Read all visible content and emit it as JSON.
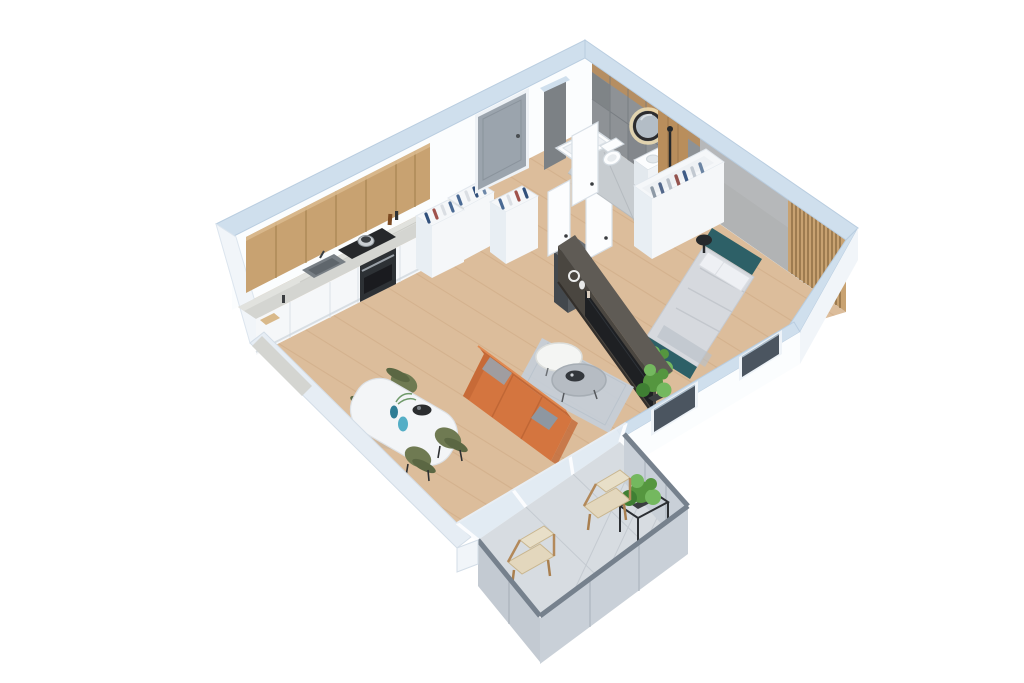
{
  "meta": {
    "description": "3D isometric dollhouse rendering of a one-bedroom apartment floor plan viewed from above on a white background. No text is visible in the image.",
    "canvas": {
      "width": 1024,
      "height": 683
    }
  },
  "palette": {
    "background": "#ffffff",
    "wall_top": "#cfdfed",
    "wall_top_edge": "#b9cde0",
    "wall_face": "#fbfdfe",
    "wall_outer": "#f1f5f9",
    "floor_wood": "#dcbd9b",
    "floor_wood_streak": "#c49c74",
    "tile_wall": "#8e9296",
    "tile_wall_dark": "#7c8185",
    "bath_floor": "#c7ccd0",
    "balcony_floor": "#d7dce1",
    "concrete": "#b1b3b4",
    "wood_cabinet": "#c8a271",
    "wood_cabinet_seam": "#a5824f",
    "wood_panel": "#b98e5c",
    "marble": "#d4d5d1",
    "cabinet_white": "#f5f7f9",
    "appliance_dark": "#2d3135",
    "door_gray": "#9ba4ad",
    "door_white": "#fcfdfe",
    "bed_teal": "#2d6067",
    "bedding": "#d6d9de",
    "pillow": "#eef0f4",
    "sofa_orange": "#d4753f",
    "sofa_orange_dark": "#c36836",
    "rug": "#c5ced7",
    "chair_green": "#6f7a52",
    "chair_green_dark": "#5b6743",
    "plant_green": "#55963f",
    "plant_green_light": "#74b85f",
    "plant_green_dark": "#3f7f33",
    "tv_wall": "#4a4640",
    "tv_wall_top": "#5f5b55",
    "tv_screen": "#1e2023",
    "railing_panel": "#c9d0d8",
    "railing_rail": "#76818d",
    "glass": "#dfe9f2",
    "window_glass": "#4b5560",
    "mirror_glow": "#f1e0b4",
    "vase_blue": "#2e7d95",
    "vase_blue_light": "#54aec6",
    "clothes_blue": "#4a6a94",
    "clothes_red": "#a0524c",
    "clothes_light": "#dadee3"
  },
  "rooms": {
    "kitchen": {
      "items": [
        "wood-upper-cabinets",
        "marble-countertop",
        "sink",
        "cooktop-with-pot",
        "oven",
        "open-storage-boxes",
        "counter-accessories"
      ]
    },
    "hallway": {
      "items": [
        "entrance-door",
        "open-wardrobe-with-clothes",
        "dark-laundry-box",
        "open-white-doors"
      ]
    },
    "bathroom": {
      "items": [
        "gray-tile-walls",
        "bathtub",
        "toilet",
        "washbasin-cabinet",
        "round-backlit-mirror",
        "wood-shower-panel",
        "open-door"
      ]
    },
    "bedroom": {
      "items": [
        "teal-double-bed",
        "gray-duvet",
        "pillows",
        "open-wardrobe-with-clothes",
        "black-side-table",
        "plant",
        "wood-slat-accent-wall",
        "two-windows"
      ]
    },
    "living_room": {
      "items": [
        "orange-sofa",
        "gray-throw-pillows",
        "gray-rug",
        "white-coffee-table",
        "gray-coffee-table",
        "dark-tv-media-wall",
        "television",
        "white-decor",
        "floor-plant"
      ]
    },
    "dining_area": {
      "items": [
        "white-table",
        "four-green-chairs",
        "blue-glass-vases",
        "dark-serving-tray"
      ]
    },
    "balcony": {
      "items": [
        "glass-sliding-wall",
        "gray-tile-floor",
        "gray-railing-panels",
        "two-wooden-lounge-chairs",
        "plant-in-black-stand"
      ]
    }
  }
}
